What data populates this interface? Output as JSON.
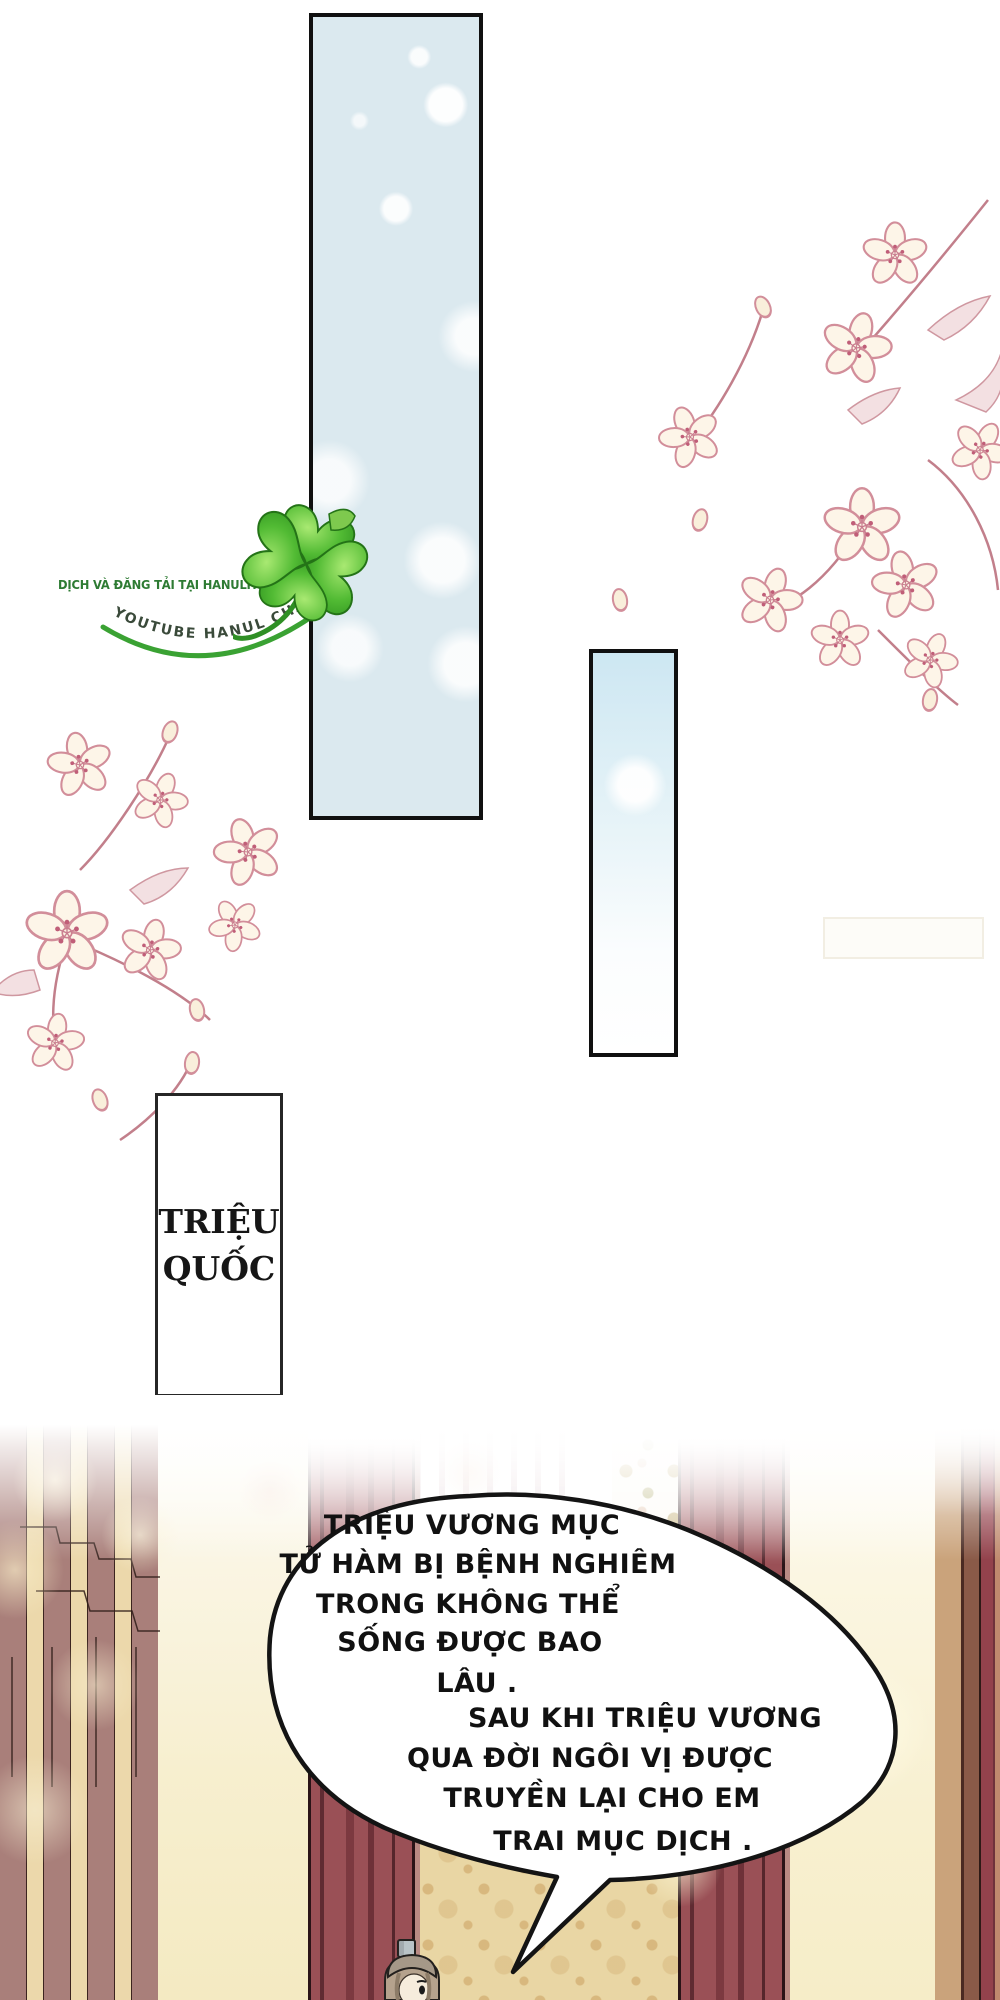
{
  "page": {
    "type_label": "manhwa-page",
    "bg": "#ffffff"
  },
  "watermark": {
    "site_line": "DỊCH VÀ ĐĂNG TẢI TẠI HANULTRUYEN.COM",
    "channel_line": "YOUTUBE HANUL CHANNEL",
    "site_color": "#2e7b33",
    "swoosh_color": "#3aa233",
    "clover_icon": "four-leaf-clover"
  },
  "panels": {
    "tall_panel_bg": "#dbe9ef",
    "small_panel_bg": "#cde7f2",
    "border_color": "#101010"
  },
  "caption_box": {
    "lines": [
      "TRIỆU",
      "QUỐC"
    ],
    "text_color": "#161616",
    "border_color": "#262626"
  },
  "speech_bubble": {
    "fill": "#ffffff",
    "stroke": "#141414",
    "text_color": "#111111",
    "lines": [
      "TRIỆU VƯƠNG MỤC",
      "TỬ HÀM BỊ BỆNH NGHIÊM",
      "TRONG KHÔNG THỂ",
      "SỐNG ĐƯỢC BAO",
      "LÂU .",
      "SAU KHI TRIỆU VƯƠNG",
      "QUA ĐỜI NGÔI VỊ ĐƯỢC",
      "TRUYỀN LẠI CHO EM",
      "TRAI MỤC DỊCH ."
    ]
  },
  "scene": {
    "pillar_color": "#9a5056",
    "pillar_shade": "#5f2b32",
    "wall_pattern_bg": "#e9d6a4",
    "wall_pattern_motif": "#d8b87e",
    "left_wall_mauve": "#a97f7a",
    "left_wall_cream": "#ecd8ab",
    "glow_color": "#f6edc8"
  },
  "decorations": {
    "blossom_outline": "#d28e9a",
    "blossom_fill": "#fdf5e8",
    "stamen_color": "#c05e78"
  }
}
